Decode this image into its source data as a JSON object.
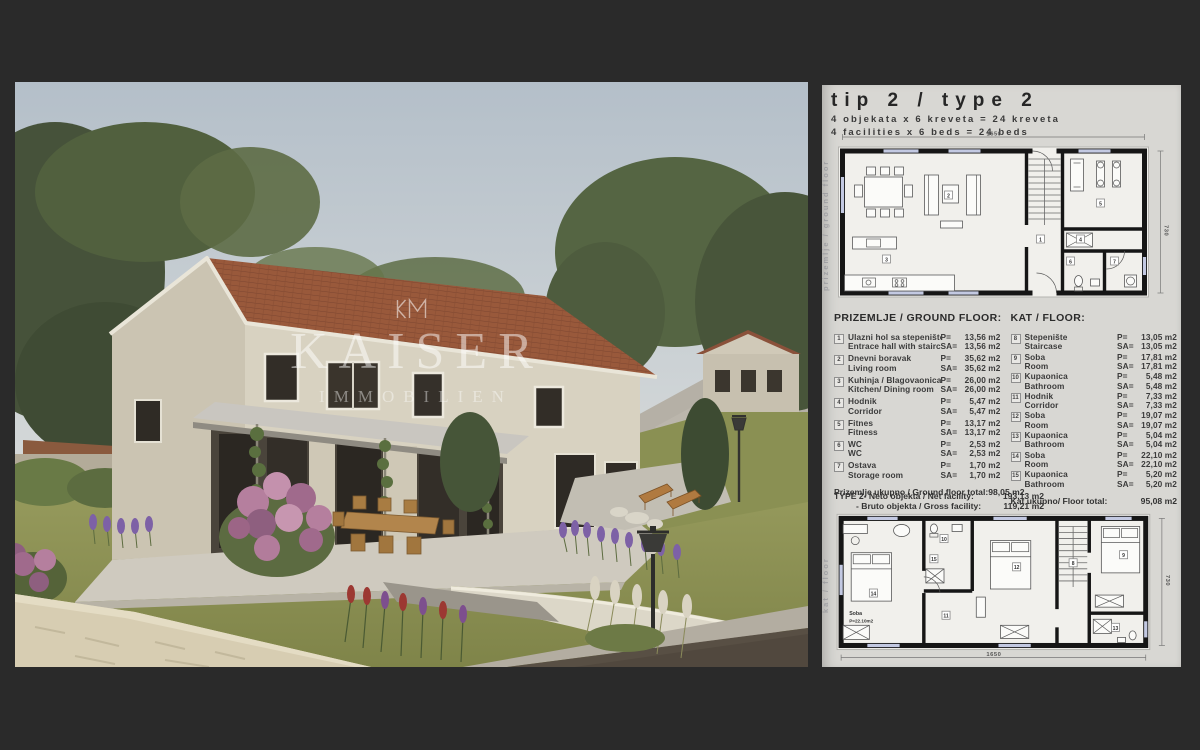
{
  "watermark": {
    "monogram": "KM",
    "brand": "KAISER",
    "brand_sub": "IMMOBILIEN"
  },
  "panel": {
    "title": "tip 2 / type 2",
    "capacity_line_hr": "4 objekata x 6 kreveta = 24 kreveta",
    "capacity_line_en": "4 facilities x 6 beds = 24 beds",
    "area_labels": {
      "p": "P=",
      "sa": "SA="
    },
    "ground_floor": {
      "heading": "PRIZEMLJE / GROUND FLOOR:",
      "side_label": "prizemlje / ground floor",
      "plan": {
        "dim_width": "1650",
        "dim_height": "730"
      },
      "rooms": [
        {
          "num": "1",
          "name_hr": "Ulazni hol sa stepeništem",
          "name_en": "Entrace hall with staircase",
          "p": "13,56 m2",
          "sa": "13,56 m2"
        },
        {
          "num": "2",
          "name_hr": "Dnevni boravak",
          "name_en": "Living room",
          "p": "35,62 m2",
          "sa": "35,62 m2"
        },
        {
          "num": "3",
          "name_hr": "Kuhinja / Blagovaonica",
          "name_en": "Kitchen/ Dining room",
          "p": "26,00 m2",
          "sa": "26,00 m2"
        },
        {
          "num": "4",
          "name_hr": "Hodnik",
          "name_en": "Corridor",
          "p": "5,47 m2",
          "sa": "5,47 m2"
        },
        {
          "num": "5",
          "name_hr": "Fitnes",
          "name_en": "Fitness",
          "p": "13,17 m2",
          "sa": "13,17 m2"
        },
        {
          "num": "6",
          "name_hr": "WC",
          "name_en": "WC",
          "p": "2,53 m2",
          "sa": "2,53 m2"
        },
        {
          "num": "7",
          "name_hr": "Ostava",
          "name_en": "Storage room",
          "p": "1,70 m2",
          "sa": "1,70 m2"
        }
      ],
      "total_label": "Prizemlje ukupno / Ground floor total:",
      "total_value": "98,05 m2"
    },
    "floor": {
      "heading": "KAT / FLOOR:",
      "side_label": "kat / floor",
      "plan": {
        "dim_width": "1650",
        "dim_height": "730",
        "room_label_line1": "Soba",
        "room_label_line2": "P=22.10m2"
      },
      "rooms": [
        {
          "num": "8",
          "name_hr": "Stepenište",
          "name_en": "Staircase",
          "p": "13,05 m2",
          "sa": "13,05 m2"
        },
        {
          "num": "9",
          "name_hr": "Soba",
          "name_en": "Room",
          "p": "17,81 m2",
          "sa": "17,81 m2"
        },
        {
          "num": "10",
          "name_hr": "Kupaonica",
          "name_en": "Bathroom",
          "p": "5,48 m2",
          "sa": "5,48 m2"
        },
        {
          "num": "11",
          "name_hr": "Hodnik",
          "name_en": "Corridor",
          "p": "7,33 m2",
          "sa": "7,33 m2"
        },
        {
          "num": "12",
          "name_hr": "Soba",
          "name_en": "Room",
          "p": "19,07 m2",
          "sa": "19,07 m2"
        },
        {
          "num": "13",
          "name_hr": "Kupaonica",
          "name_en": "Bathroom",
          "p": "5,04 m2",
          "sa": "5,04 m2"
        },
        {
          "num": "14",
          "name_hr": "Soba",
          "name_en": "Room",
          "p": "22,10 m2",
          "sa": "22,10 m2"
        },
        {
          "num": "15",
          "name_hr": "Kupaonica",
          "name_en": "Bathroom",
          "p": "5,20 m2",
          "sa": "5,20 m2"
        }
      ],
      "total_label": "Kat ukupno/ Floor total:",
      "total_value": "95,08 m2"
    },
    "type_summary": {
      "net_label": "TYPE 2- Neto objekta / Net facility:",
      "net_value": "193,13 m2",
      "gross_label": "- Bruto objekta / Gross facility:",
      "gross_value": "119,21 m2"
    }
  },
  "colors": {
    "background": "#2a2a2a",
    "panel_bg": "#d8d7d3",
    "plan_wall": "#161616",
    "plan_window": "#c3c9e2",
    "roof": "#99593b",
    "stone_facade": "#d6d0c0",
    "lawn": "#8d9355",
    "watermark": "rgba(255,255,255,0.5)"
  }
}
